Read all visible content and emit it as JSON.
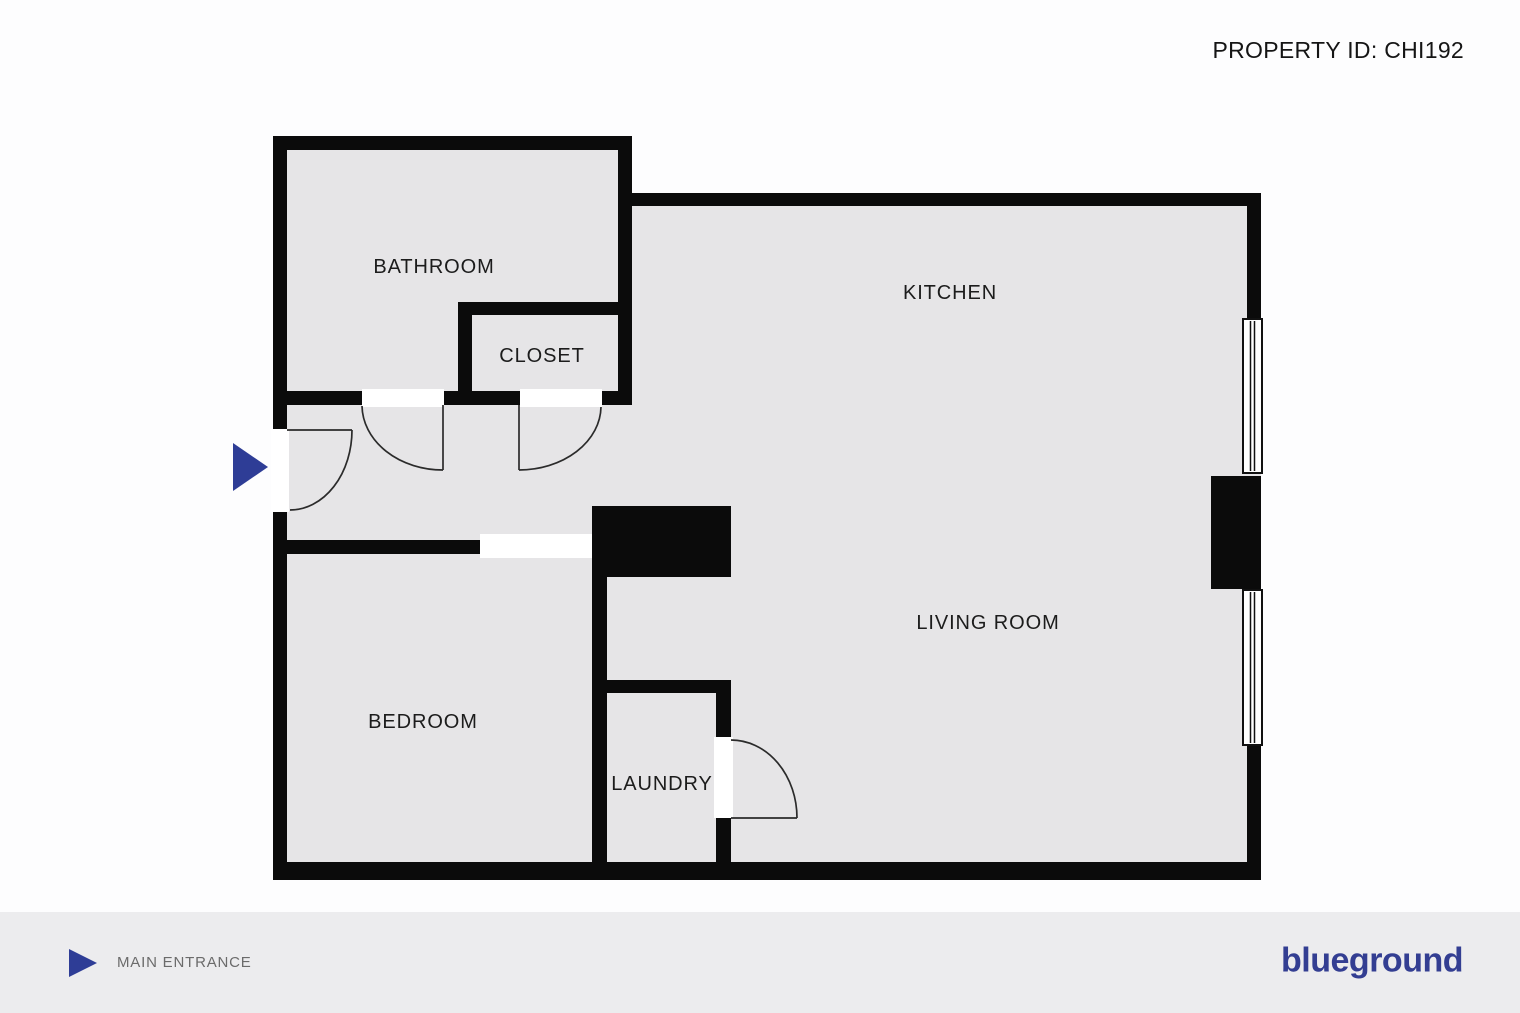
{
  "header": {
    "property_id": "PROPERTY ID: CHI192"
  },
  "plan": {
    "rooms": {
      "bathroom": "BATHROOM",
      "closet": "CLOSET",
      "kitchen": "KITCHEN",
      "living_room": "LIVING ROOM",
      "bedroom": "BEDROOM",
      "laundry": "LAUNDRY"
    }
  },
  "legend": {
    "main_entrance": "MAIN ENTRANCE"
  },
  "brand": {
    "logo": "blueground"
  },
  "colors": {
    "accent_blue": "#2e3d96",
    "logo_blue": "#333e92",
    "wall_black": "#0b0b0b",
    "floor_gray": "#e6e5e7",
    "footer_gray": "#ececee",
    "label_text": "#1c1c1c",
    "legend_text": "#6b6b6b"
  }
}
